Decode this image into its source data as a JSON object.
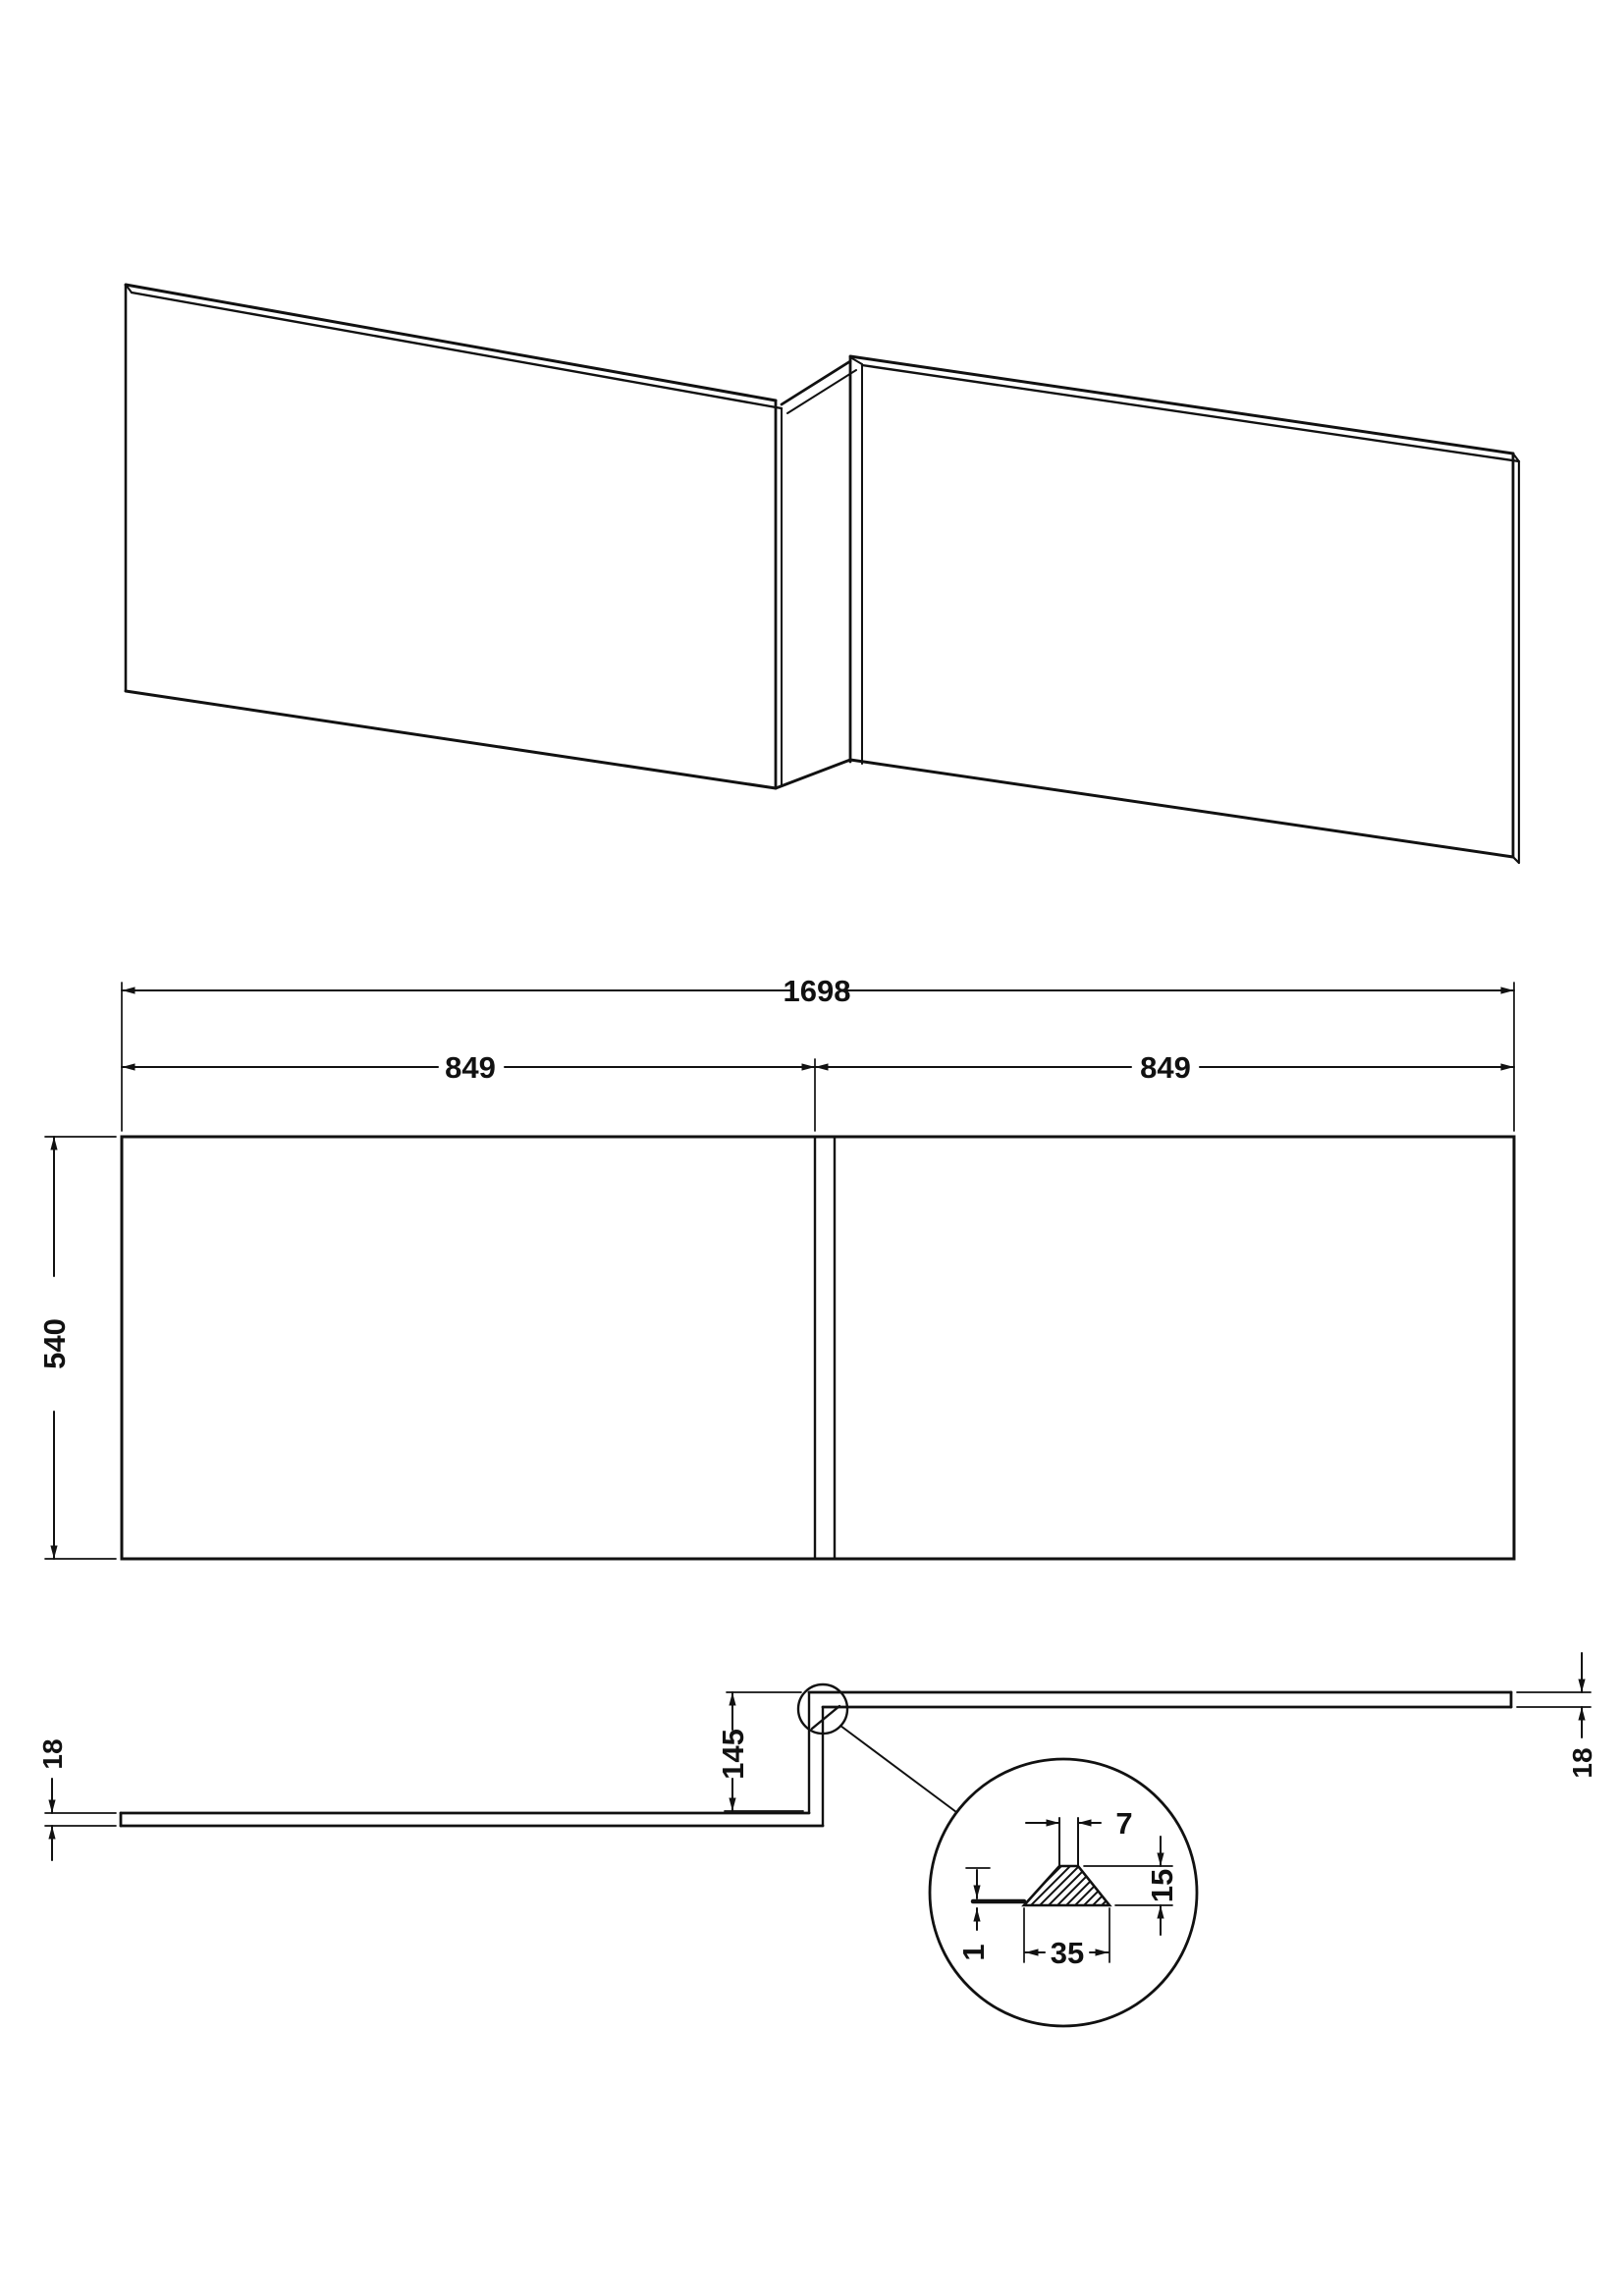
{
  "drawing": {
    "kind": "bath-panel-technical-drawing",
    "colors": {
      "line": "#111111",
      "background": "#ffffff"
    },
    "front_elevation": {
      "dim_overall_width": "1698",
      "dim_left_panel_width": "849",
      "dim_right_panel_width": "849",
      "dim_height": "540"
    },
    "plan": {
      "dim_left_thickness": "18",
      "dim_right_thickness": "18",
      "dim_return_depth": "145"
    },
    "detail": {
      "dim_top_gap": "7",
      "dim_block_height": "15",
      "dim_block_width": "35",
      "dim_edge_offset": "1"
    }
  }
}
